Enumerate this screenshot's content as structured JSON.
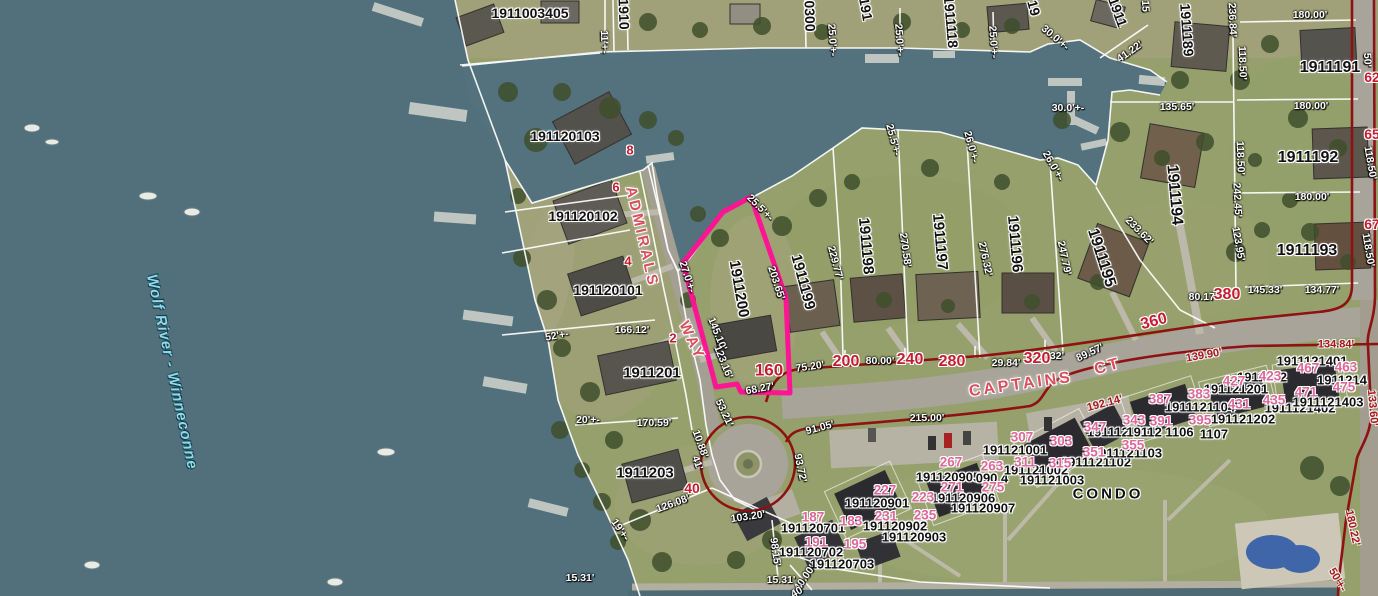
{
  "map": {
    "highlighted_parcel": {
      "parcel_id": "1911200",
      "street_number": "160",
      "outline_color": "#ff1493"
    },
    "water_body_label": {
      "text": "Wolf River - Winneconne",
      "x": 172,
      "y": 372,
      "rotate": 78
    },
    "street_labels": [
      {
        "text": "ADMIRALS",
        "x": 642,
        "y": 237,
        "rotate": 77
      },
      {
        "text": "WAY",
        "x": 692,
        "y": 341,
        "rotate": 65
      },
      {
        "text": "CAPTAINS",
        "x": 1021,
        "y": 385,
        "rotate": -8,
        "size": 16
      },
      {
        "text": "CT",
        "x": 1108,
        "y": 367,
        "rotate": -15,
        "size": 16
      }
    ],
    "area_labels": [
      {
        "text": "CONDO",
        "x": 1108,
        "y": 494
      }
    ],
    "parcel_id_labels": [
      {
        "text": "1911003405",
        "x": 530,
        "y": 13
      },
      {
        "text": "1910",
        "x": 624,
        "y": 14,
        "rotate": 88
      },
      {
        "text": "0300",
        "x": 810,
        "y": 16,
        "rotate": 88
      },
      {
        "text": "191",
        "x": 866,
        "y": 9,
        "rotate": 80
      },
      {
        "text": "1911118",
        "x": 951,
        "y": 22,
        "rotate": 85
      },
      {
        "text": "19",
        "x": 1034,
        "y": 8,
        "rotate": 75
      },
      {
        "text": "1911",
        "x": 1118,
        "y": 12,
        "rotate": 70
      },
      {
        "text": "1911189",
        "x": 1187,
        "y": 30,
        "rotate": 86
      },
      {
        "text": "1911191",
        "x": 1330,
        "y": 68,
        "size": 16
      },
      {
        "text": "1911192",
        "x": 1308,
        "y": 158,
        "size": 16
      },
      {
        "text": "1911193",
        "x": 1307,
        "y": 251,
        "size": 16
      },
      {
        "text": "1911194",
        "x": 1174,
        "y": 195,
        "rotate": 85,
        "size": 16
      },
      {
        "text": "1911195",
        "x": 1101,
        "y": 258,
        "rotate": 72,
        "size": 16
      },
      {
        "text": "1911196",
        "x": 1015,
        "y": 244,
        "rotate": 85,
        "size": 15
      },
      {
        "text": "1911197",
        "x": 940,
        "y": 242,
        "rotate": 85,
        "size": 15
      },
      {
        "text": "1911198",
        "x": 866,
        "y": 246,
        "rotate": 85,
        "size": 15
      },
      {
        "text": "1911199",
        "x": 803,
        "y": 282,
        "rotate": 75,
        "size": 15
      },
      {
        "text": "191120103",
        "x": 565,
        "y": 136
      },
      {
        "text": "191120102",
        "x": 583,
        "y": 216
      },
      {
        "text": "191120101",
        "x": 608,
        "y": 290
      },
      {
        "text": "1911201",
        "x": 652,
        "y": 373,
        "size": 15
      },
      {
        "text": "1911203",
        "x": 645,
        "y": 473,
        "size": 15
      },
      {
        "text": "1911200",
        "x": 739,
        "y": 289,
        "rotate": 80,
        "size": 15
      },
      {
        "text": "191120901",
        "x": 877,
        "y": 503,
        "size": 13
      },
      {
        "text": "191120902",
        "x": 895,
        "y": 526,
        "size": 13
      },
      {
        "text": "191120903",
        "x": 914,
        "y": 537,
        "size": 13
      },
      {
        "text": "191120905",
        "x": 948,
        "y": 477,
        "size": 13
      },
      {
        "text": "090 4",
        "x": 992,
        "y": 478,
        "size": 13
      },
      {
        "text": "191120906",
        "x": 963,
        "y": 498,
        "size": 13
      },
      {
        "text": "191120907",
        "x": 983,
        "y": 508,
        "size": 13
      },
      {
        "text": "191120701",
        "x": 813,
        "y": 528,
        "size": 13
      },
      {
        "text": "191120702",
        "x": 811,
        "y": 552,
        "size": 13
      },
      {
        "text": "191120703",
        "x": 842,
        "y": 564,
        "size": 13
      },
      {
        "text": "191121001",
        "x": 1015,
        "y": 450,
        "size": 13
      },
      {
        "text": "191121002",
        "x": 1036,
        "y": 470,
        "size": 13
      },
      {
        "text": "191121003",
        "x": 1052,
        "y": 480,
        "size": 13
      },
      {
        "text": "1911121101",
        "x": 1122,
        "y": 432,
        "size": 13
      },
      {
        "text": "1911121102",
        "x": 1096,
        "y": 462,
        "size": 13
      },
      {
        "text": "1911121103",
        "x": 1127,
        "y": 453,
        "size": 13
      },
      {
        "text": "1911121104",
        "x": 1200,
        "y": 407,
        "size": 13
      },
      {
        "text": "19112 1106",
        "x": 1160,
        "y": 432,
        "size": 13
      },
      {
        "text": "1107",
        "x": 1214,
        "y": 434,
        "size": 13
      },
      {
        "text": "191121201",
        "x": 1236,
        "y": 389,
        "size": 13
      },
      {
        "text": "1911212",
        "x": 1262,
        "y": 377,
        "size": 13
      },
      {
        "text": "191121202",
        "x": 1243,
        "y": 419,
        "size": 13
      },
      {
        "text": "1911121401",
        "x": 1312,
        "y": 361,
        "size": 13
      },
      {
        "text": "1911121402",
        "x": 1300,
        "y": 408,
        "size": 13
      },
      {
        "text": "1911121403",
        "x": 1328,
        "y": 402,
        "size": 13
      },
      {
        "text": "1911214",
        "x": 1342,
        "y": 380,
        "size": 13
      }
    ],
    "street_number_labels": [
      {
        "text": "8",
        "x": 630,
        "y": 150,
        "size": 13
      },
      {
        "text": "6",
        "x": 616,
        "y": 187,
        "size": 13
      },
      {
        "text": "4",
        "x": 628,
        "y": 261,
        "size": 13
      },
      {
        "text": "2",
        "x": 673,
        "y": 338,
        "size": 13
      },
      {
        "text": "40",
        "x": 692,
        "y": 488,
        "size": 14
      },
      {
        "text": "160",
        "x": 769,
        "y": 370,
        "size": 17
      },
      {
        "text": "200",
        "x": 846,
        "y": 362,
        "size": 16
      },
      {
        "text": "240",
        "x": 910,
        "y": 360,
        "size": 16
      },
      {
        "text": "280",
        "x": 952,
        "y": 362,
        "size": 16
      },
      {
        "text": "320",
        "x": 1037,
        "y": 359,
        "size": 16
      },
      {
        "text": "360",
        "x": 1154,
        "y": 322,
        "rotate": -15,
        "size": 16
      },
      {
        "text": "380",
        "x": 1227,
        "y": 295,
        "size": 16
      },
      {
        "text": "62",
        "x": 1372,
        "y": 77,
        "size": 14
      },
      {
        "text": "65",
        "x": 1372,
        "y": 134,
        "size": 14
      },
      {
        "text": "67",
        "x": 1372,
        "y": 224,
        "size": 14
      }
    ],
    "unit_number_labels": [
      {
        "text": "187",
        "x": 813,
        "y": 517
      },
      {
        "text": "183",
        "x": 851,
        "y": 521
      },
      {
        "text": "191",
        "x": 816,
        "y": 542
      },
      {
        "text": "195",
        "x": 855,
        "y": 544
      },
      {
        "text": "227",
        "x": 885,
        "y": 490
      },
      {
        "text": "223",
        "x": 923,
        "y": 497
      },
      {
        "text": "231",
        "x": 886,
        "y": 516
      },
      {
        "text": "235",
        "x": 925,
        "y": 515
      },
      {
        "text": "267",
        "x": 951,
        "y": 462
      },
      {
        "text": "263",
        "x": 992,
        "y": 466
      },
      {
        "text": "271",
        "x": 952,
        "y": 487
      },
      {
        "text": "275",
        "x": 993,
        "y": 487
      },
      {
        "text": "307",
        "x": 1022,
        "y": 437
      },
      {
        "text": "303",
        "x": 1061,
        "y": 441
      },
      {
        "text": "311",
        "x": 1025,
        "y": 462
      },
      {
        "text": "315",
        "x": 1060,
        "y": 463
      },
      {
        "text": "347",
        "x": 1095,
        "y": 427
      },
      {
        "text": "343",
        "x": 1134,
        "y": 420
      },
      {
        "text": "351",
        "x": 1094,
        "y": 452
      },
      {
        "text": "355",
        "x": 1133,
        "y": 445
      },
      {
        "text": "387",
        "x": 1160,
        "y": 399
      },
      {
        "text": "383",
        "x": 1199,
        "y": 394
      },
      {
        "text": "391",
        "x": 1161,
        "y": 421
      },
      {
        "text": "395",
        "x": 1200,
        "y": 420
      },
      {
        "text": "427",
        "x": 1234,
        "y": 381
      },
      {
        "text": "423",
        "x": 1270,
        "y": 376
      },
      {
        "text": "431",
        "x": 1239,
        "y": 404
      },
      {
        "text": "435",
        "x": 1274,
        "y": 400
      },
      {
        "text": "467",
        "x": 1308,
        "y": 368
      },
      {
        "text": "463",
        "x": 1346,
        "y": 367
      },
      {
        "text": "471",
        "x": 1306,
        "y": 392
      },
      {
        "text": "475",
        "x": 1344,
        "y": 387
      }
    ],
    "dimension_labels": [
      {
        "text": "11'+-",
        "x": 604,
        "y": 42,
        "rotate": 88
      },
      {
        "text": "15",
        "x": 1145,
        "y": 6,
        "rotate": 88
      },
      {
        "text": "25.0'+-",
        "x": 832,
        "y": 40,
        "rotate": 86
      },
      {
        "text": "25.0'+-",
        "x": 899,
        "y": 40,
        "rotate": 86
      },
      {
        "text": "25.0'+-",
        "x": 993,
        "y": 42,
        "rotate": 86
      },
      {
        "text": "30.0'+-",
        "x": 1055,
        "y": 38,
        "rotate": 40
      },
      {
        "text": "41.22'",
        "x": 1130,
        "y": 52,
        "rotate": -35
      },
      {
        "text": "30.0'+-",
        "x": 1068,
        "y": 108
      },
      {
        "text": "135.65'",
        "x": 1177,
        "y": 107
      },
      {
        "text": "236.84'",
        "x": 1232,
        "y": 20,
        "rotate": 88
      },
      {
        "text": "118.50'",
        "x": 1242,
        "y": 63,
        "rotate": 88
      },
      {
        "text": "180.00'",
        "x": 1310,
        "y": 15
      },
      {
        "text": "50'",
        "x": 1367,
        "y": 60,
        "rotate": 88
      },
      {
        "text": "180.00'",
        "x": 1311,
        "y": 106
      },
      {
        "text": "118.50'",
        "x": 1240,
        "y": 158,
        "rotate": 88
      },
      {
        "text": "118.50'",
        "x": 1370,
        "y": 163,
        "rotate": 80
      },
      {
        "text": "180.00'",
        "x": 1312,
        "y": 197
      },
      {
        "text": "242.45'",
        "x": 1237,
        "y": 200,
        "rotate": 87
      },
      {
        "text": "118.50'",
        "x": 1368,
        "y": 250,
        "rotate": 80
      },
      {
        "text": "123.95'",
        "x": 1238,
        "y": 244,
        "rotate": 80
      },
      {
        "text": "145.33'",
        "x": 1265,
        "y": 290
      },
      {
        "text": "134.77'",
        "x": 1322,
        "y": 290
      },
      {
        "text": "80.17'",
        "x": 1203,
        "y": 297
      },
      {
        "text": "233.62'",
        "x": 1139,
        "y": 231,
        "rotate": 45
      },
      {
        "text": "247.79'",
        "x": 1064,
        "y": 258,
        "rotate": 78
      },
      {
        "text": "276.32'",
        "x": 985,
        "y": 259,
        "rotate": 78
      },
      {
        "text": "270.58'",
        "x": 905,
        "y": 250,
        "rotate": 82
      },
      {
        "text": "229.77'",
        "x": 835,
        "y": 263,
        "rotate": 75
      },
      {
        "text": "25.5'+-",
        "x": 893,
        "y": 140,
        "rotate": 75
      },
      {
        "text": "26.0'+-",
        "x": 971,
        "y": 147,
        "rotate": 75
      },
      {
        "text": "26.0'+-",
        "x": 1053,
        "y": 166,
        "rotate": 60
      },
      {
        "text": "75.20'",
        "x": 810,
        "y": 367,
        "rotate": -8
      },
      {
        "text": "80.00'",
        "x": 880,
        "y": 361
      },
      {
        "text": "29.84'",
        "x": 1006,
        "y": 363
      },
      {
        "text": "32'",
        "x": 1057,
        "y": 356
      },
      {
        "text": "89.57'",
        "x": 1090,
        "y": 353,
        "rotate": -25
      },
      {
        "text": "166.12'",
        "x": 632,
        "y": 330
      },
      {
        "text": "52'+-",
        "x": 557,
        "y": 336,
        "rotate": -10
      },
      {
        "text": "20'+-",
        "x": 588,
        "y": 420
      },
      {
        "text": "170.59'",
        "x": 654,
        "y": 423
      },
      {
        "text": "27.0'+-",
        "x": 687,
        "y": 277,
        "rotate": 72
      },
      {
        "text": "145.10'",
        "x": 717,
        "y": 334,
        "rotate": 68
      },
      {
        "text": "123.16'",
        "x": 723,
        "y": 362,
        "rotate": 68
      },
      {
        "text": "203.65'",
        "x": 776,
        "y": 283,
        "rotate": 72
      },
      {
        "text": "68.27'",
        "x": 760,
        "y": 389,
        "rotate": -10
      },
      {
        "text": "25.5'+-",
        "x": 760,
        "y": 208,
        "rotate": 45
      },
      {
        "text": "53.21'",
        "x": 724,
        "y": 413,
        "rotate": 65
      },
      {
        "text": "10.88'",
        "x": 700,
        "y": 444,
        "rotate": 70
      },
      {
        "text": "41'",
        "x": 697,
        "y": 463,
        "rotate": 70
      },
      {
        "text": "126.08'",
        "x": 673,
        "y": 504,
        "rotate": -20
      },
      {
        "text": "19'+-",
        "x": 620,
        "y": 530,
        "rotate": 55
      },
      {
        "text": "91.05'",
        "x": 820,
        "y": 428,
        "rotate": -15
      },
      {
        "text": "215.00'",
        "x": 927,
        "y": 418
      },
      {
        "text": "93.72'",
        "x": 800,
        "y": 468,
        "rotate": 78
      },
      {
        "text": "103.20'",
        "x": 748,
        "y": 517,
        "rotate": -8
      },
      {
        "text": "98.15'",
        "x": 775,
        "y": 552,
        "rotate": 82
      },
      {
        "text": "15.31'",
        "x": 580,
        "y": 578
      },
      {
        "text": "15.31'",
        "x": 781,
        "y": 580
      },
      {
        "text": "40.00'",
        "x": 805,
        "y": 578,
        "rotate": -55
      },
      {
        "text": "40'",
        "x": 798,
        "y": 592,
        "rotate": -30
      }
    ],
    "red_dimension_labels": [
      {
        "text": "134.84'",
        "x": 1336,
        "y": 345
      },
      {
        "text": "139.90'",
        "x": 1204,
        "y": 356,
        "rotate": -10
      },
      {
        "text": "192.14'",
        "x": 1105,
        "y": 404,
        "rotate": -15
      },
      {
        "text": "133.60'",
        "x": 1372,
        "y": 408,
        "rotate": 85
      },
      {
        "text": "180.22'",
        "x": 1352,
        "y": 528,
        "rotate": 78
      },
      {
        "text": "50'+-",
        "x": 1337,
        "y": 580,
        "rotate": 60
      }
    ]
  },
  "colors": {
    "water": "#52707b",
    "land": "#96a06c",
    "road": "#a8a49a",
    "parcel_line_white": "#ffffff",
    "row_line_dark_red": "#8e1212",
    "highlight_magenta": "#ff1493",
    "parcel_text": "#111111",
    "dimension_text": "#ffffff",
    "red_dimension_text": "#a81616",
    "street_number_red": "#c41d32",
    "unit_number_pink": "#df679b",
    "street_name_red": "#d94f5c",
    "water_label_cyan": "#90d9ea"
  }
}
